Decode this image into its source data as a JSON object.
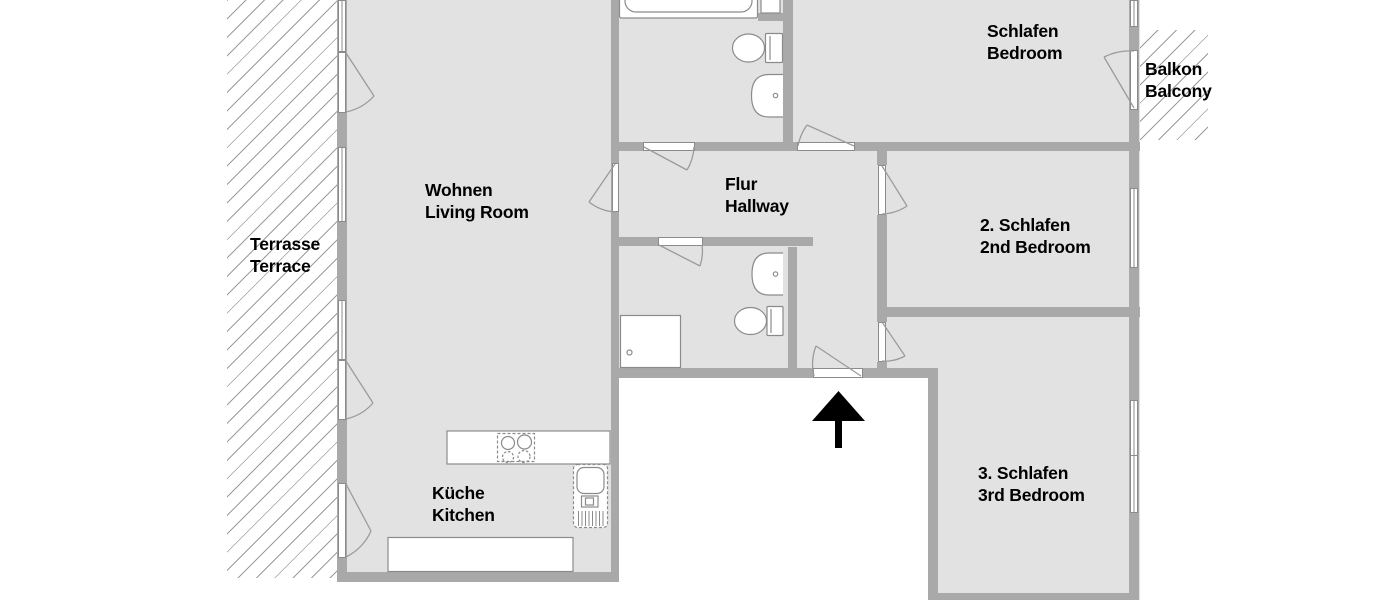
{
  "plan": {
    "rooms": [
      {
        "id": "living",
        "label_de": "Wohnen",
        "label_en": "Living Room"
      },
      {
        "id": "kitchen",
        "label_de": "Küche",
        "label_en": "Kitchen"
      },
      {
        "id": "hallway",
        "label_de": "Flur",
        "label_en": "Hallway"
      },
      {
        "id": "bedroom",
        "label_de": "Schlafen",
        "label_en": "Bedroom"
      },
      {
        "id": "bedroom2",
        "label_de": "2. Schlafen",
        "label_en": "2nd Bedroom"
      },
      {
        "id": "bedroom3",
        "label_de": "3. Schlafen",
        "label_en": "3rd Bedroom"
      },
      {
        "id": "terrace",
        "label_de": "Terrasse",
        "label_en": "Terrace"
      },
      {
        "id": "balcony",
        "label_de": "Balkon",
        "label_en": "Balcony"
      }
    ],
    "entrance": {
      "marker": "arrow-up"
    },
    "fixtures": [
      "bathtub",
      "toilet",
      "washbasin",
      "shower",
      "stove",
      "kitchen-sink",
      "countertop"
    ],
    "colors": {
      "background": "#ffffff",
      "room_fill": "#e2e2e2",
      "wall": "#a9a9a9",
      "outline": "#8b8b8b",
      "hatch_line": "#9c9c9c",
      "text": "#000000",
      "arrow": "#000000"
    }
  }
}
